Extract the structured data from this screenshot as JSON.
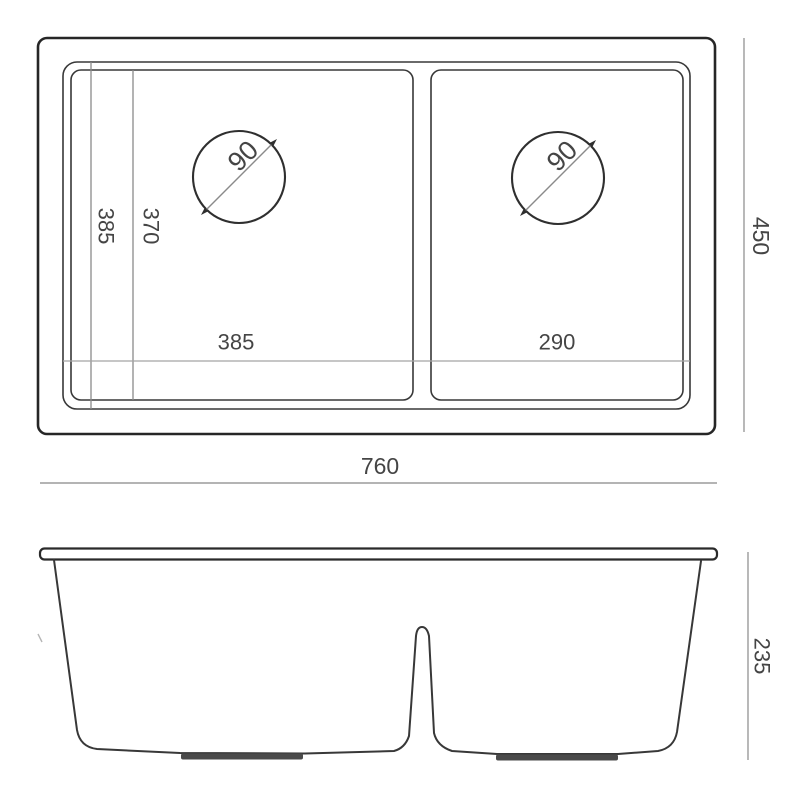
{
  "drawing": {
    "title": "double-bowl-sink-dimension-drawing",
    "top_view": {
      "drain1_diameter": "90",
      "drain2_diameter": "90",
      "left_outer_depth": "385",
      "left_inner_depth": "370",
      "bowl1_width": "385",
      "bowl2_width": "290",
      "overall_depth": "450",
      "overall_width": "760"
    },
    "front_view": {
      "overall_height": "235"
    },
    "colors": {
      "outline": "#262626",
      "inner_line": "#383838",
      "dimension_line": "#9b9b9b",
      "label_text": "#454545"
    }
  }
}
